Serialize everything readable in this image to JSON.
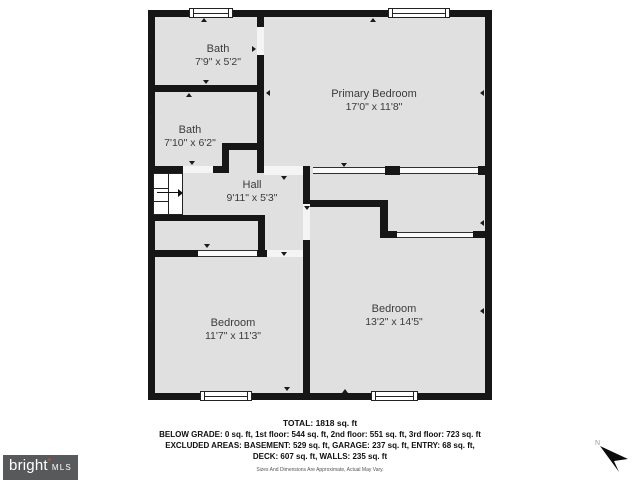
{
  "plan": {
    "rooms": [
      {
        "id": "bath-upper",
        "name": "Bath",
        "dims": "7'9\" x 5'2\""
      },
      {
        "id": "bath-lower",
        "name": "Bath",
        "dims": "7'10\" x 6'2\""
      },
      {
        "id": "primary-bedroom",
        "name": "Primary Bedroom",
        "dims": "17'0\" x 11'8\""
      },
      {
        "id": "hall",
        "name": "Hall",
        "dims": "9'11\" x 5'3\""
      },
      {
        "id": "bedroom-left",
        "name": "Bedroom",
        "dims": "11'7\" x 11'3\""
      },
      {
        "id": "bedroom-right",
        "name": "Bedroom",
        "dims": "13'2\" x 14'5\""
      }
    ]
  },
  "summary": {
    "total": "TOTAL: 1818 sq. ft",
    "line2": "BELOW GRADE: 0 sq. ft, 1st floor: 544 sq. ft, 2nd floor: 551 sq. ft, 3rd floor: 723 sq. ft",
    "line3": "EXCLUDED AREAS: BASEMENT: 529 sq. ft, GARAGE: 237 sq. ft, ENTRY: 68 sq. ft,",
    "line4": "DECK: 607 sq. ft, WALLS: 235 sq. ft",
    "disclaimer": "Sizes And Dimensions Are Approximate, Actual May Vary."
  },
  "branding": {
    "brand": "bright",
    "mark": "*",
    "suffix": "MLS"
  },
  "compass": {
    "north_label": "N"
  },
  "colors": {
    "floor": "#e0e0e0",
    "wall": "#161616",
    "logo_bg": "#58595b",
    "logo_mark": "#e2592a"
  }
}
